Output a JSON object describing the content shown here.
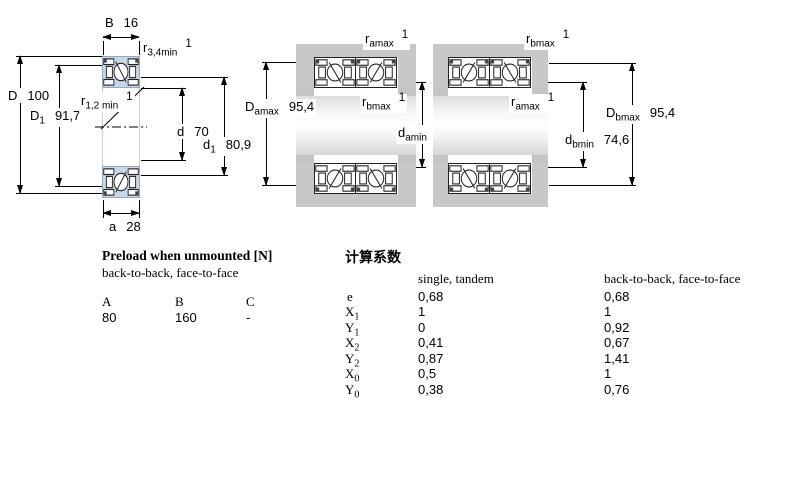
{
  "colors": {
    "bearing_blue": "#c7d7e8",
    "housing_gray": "#c8c8c8",
    "line_black": "#000000"
  },
  "single_bearing": {
    "dims": {
      "B": {
        "base": "B",
        "value": "16"
      },
      "r34": {
        "base": "r",
        "sub": "3,4min",
        "note": "1"
      },
      "D": {
        "base": "D",
        "value": "100"
      },
      "D1": {
        "base": "D",
        "sub": "1",
        "value": "91,7"
      },
      "r12": {
        "base": "r",
        "sub": "1,2 min",
        "note": "1"
      },
      "d": {
        "base": "d",
        "value": "70"
      },
      "d1": {
        "base": "d",
        "sub": "1",
        "value": "80,9"
      },
      "a": {
        "base": "a",
        "value": "28"
      }
    }
  },
  "arrangement_back_to_back": {
    "dims": {
      "ramax": {
        "base": "r",
        "sub": "amax",
        "note": "1"
      },
      "Damax": {
        "base": "D",
        "sub": "amax",
        "value": "95,4"
      },
      "rbmax": {
        "base": "r",
        "sub": "bmax",
        "note": "1"
      },
      "damin": {
        "base": "d",
        "sub": "amin",
        "value": "74,6"
      }
    }
  },
  "arrangement_face_to_face": {
    "dims": {
      "rbmax": {
        "base": "r",
        "sub": "bmax",
        "note": "1"
      },
      "ramax": {
        "base": "r",
        "sub": "amax",
        "note": "1"
      },
      "dbmin": {
        "base": "d",
        "sub": "bmin",
        "value": "74,6"
      },
      "Dbmax": {
        "base": "D",
        "sub": "bmax",
        "value": "95,4"
      }
    }
  },
  "preload_table": {
    "title": "Preload when unmounted [N]",
    "subtitle": "back-to-back, face-to-face",
    "columns": [
      "A",
      "B",
      "C"
    ],
    "values": [
      "80",
      "160",
      "-"
    ]
  },
  "factors_table": {
    "title": "计算系数",
    "col1": "single, tandem",
    "col2": "back-to-back, face-to-face",
    "rows": [
      {
        "base": "e",
        "sub": "",
        "v1": "0,68",
        "v2": "0,68"
      },
      {
        "base": "X",
        "sub": "1",
        "v1": "1",
        "v2": "1"
      },
      {
        "base": "Y",
        "sub": "1",
        "v1": "0",
        "v2": "0,92"
      },
      {
        "base": "X",
        "sub": "2",
        "v1": "0,41",
        "v2": "0,67"
      },
      {
        "base": "Y",
        "sub": "2",
        "v1": "0,87",
        "v2": "1,41"
      },
      {
        "base": "X",
        "sub": "0",
        "v1": "0,5",
        "v2": "1"
      },
      {
        "base": "Y",
        "sub": "0",
        "v1": "0,38",
        "v2": "0,76"
      }
    ]
  }
}
